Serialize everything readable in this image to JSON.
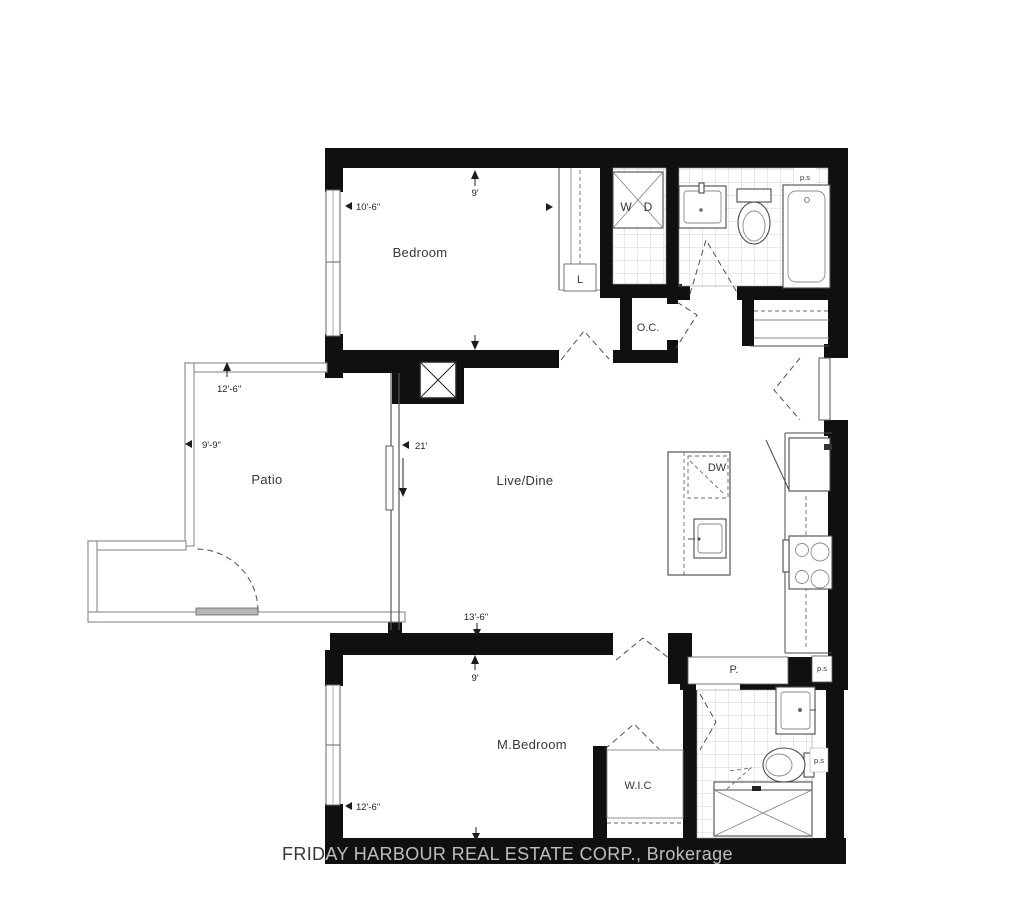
{
  "plan": {
    "rooms": {
      "bedroom": {
        "label": "Bedroom",
        "width": "10'-6\"",
        "depth": "9'"
      },
      "patio": {
        "label": "Patio",
        "width": "12'-6\"",
        "depth": "9'-9\""
      },
      "live_dine": {
        "label": "Live/Dine",
        "length": "21'",
        "width": "13'-6\""
      },
      "master_bedroom": {
        "label": "M.Bedroom",
        "width": "12'-6\"",
        "depth": "9'"
      },
      "walk_in_closet": {
        "label": "W.I.C"
      },
      "owners_closet": {
        "label": "O.C."
      },
      "linen_closet": {
        "label": "L"
      },
      "pantry": {
        "label": "P."
      }
    },
    "appliances": {
      "washer": "W",
      "dryer": "D",
      "dishwasher": "DW"
    },
    "pipe_space": {
      "label": "p.s"
    }
  },
  "watermark": {
    "text": "FRIDAY HARBOUR REAL ESTATE CORP., Brokerage"
  },
  "colors": {
    "wall": "#101010",
    "fixture_line": "#4a4a4a",
    "tile_line": "#c8c8c8",
    "background": "#ffffff",
    "watermark": "#c7c7c7"
  }
}
